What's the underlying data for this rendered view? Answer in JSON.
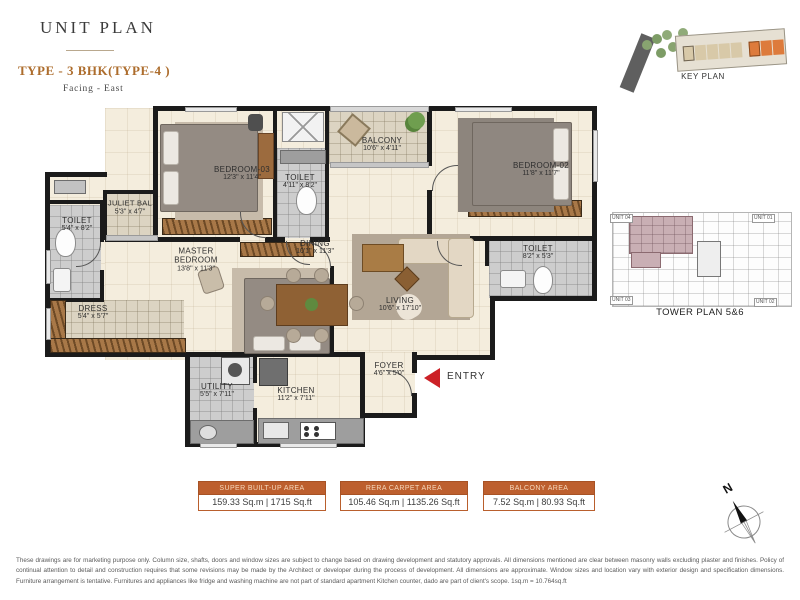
{
  "page": {
    "title": "UNIT PLAN",
    "type_label": "TYPE - 3 BHK(TYPE-4 )",
    "facing": "Facing - East"
  },
  "key_plan": {
    "caption": "KEY PLAN"
  },
  "tower_plan": {
    "caption": "TOWER PLAN 5&6",
    "units": [
      {
        "label": "UNIT 04"
      },
      {
        "label": "UNIT 01"
      },
      {
        "label": "UNIT 03"
      },
      {
        "label": "UNIT 02"
      }
    ]
  },
  "plan": {
    "entry_label": "ENTRY",
    "rooms": [
      {
        "name": "BEDROOM-03",
        "dims": "12'3\" x 11'4\""
      },
      {
        "name": "TOILET",
        "dims": "4'11\" x 8'2\""
      },
      {
        "name": "BALCONY",
        "dims": "10'6\" x 4'11\""
      },
      {
        "name": "BEDROOM-02",
        "dims": "11'8\" x 11'7\""
      },
      {
        "name": "TOILET",
        "dims": "8'2\" x 5'3\""
      },
      {
        "name": "JULIET BAL",
        "dims": "5'3\" x 4'7\""
      },
      {
        "name": "TOILET",
        "dims": "5'4\" x 8'2\""
      },
      {
        "name": "MASTER BEDROOM",
        "dims": "13'8\" x 11'3\""
      },
      {
        "name": "DINING",
        "dims": "10'1\" x 11'3\""
      },
      {
        "name": "LIVING",
        "dims": "10'6\" x 17'10\""
      },
      {
        "name": "DRESS",
        "dims": "5'4\" x 5'7\""
      },
      {
        "name": "UTILITY",
        "dims": "5'5\" x 7'11\""
      },
      {
        "name": "KITCHEN",
        "dims": "11'2\" x 7'11\""
      },
      {
        "name": "FOYER",
        "dims": "4'6\" x 5'0\""
      }
    ]
  },
  "areas": [
    {
      "title": "SUPER BUILT-UP AREA",
      "value": "159.33 Sq.m | 1715 Sq.ft"
    },
    {
      "title": "RERA CARPET AREA",
      "value": "105.46 Sq.m | 1135.26 Sq.ft"
    },
    {
      "title": "BALCONY AREA",
      "value": "7.52 Sq.m | 80.93 Sq.ft"
    }
  ],
  "compass": {
    "label": "N"
  },
  "disclaimer": "These drawings are for marketing purpose only. Column size, shafts, doors and window sizes are subject to change based on drawing development and statutory approvals. All dimensions mentioned are clear between masonry walls excluding plaster and finishes.  Policy of continual attention to detail and construction requires that some revisions may be made by the Architect or developer during the process of  development.  All dimensions are approximate. Window sizes and location vary with exterior design and specification dimensions.  Furniture arrangement is tentative.  Furnitures and appliances like fridge and washing machine are not part of standard apartment Kitchen counter, dado are part of client's scope. 1sq.m = 10.764sq.ft",
  "colors": {
    "accent_orange": "#bd5f2e",
    "type_heading": "#ad6d2d",
    "entry_red": "#cc2127",
    "wall_black": "#1b1b1b",
    "highlight_mauve": "#c9afb4"
  }
}
